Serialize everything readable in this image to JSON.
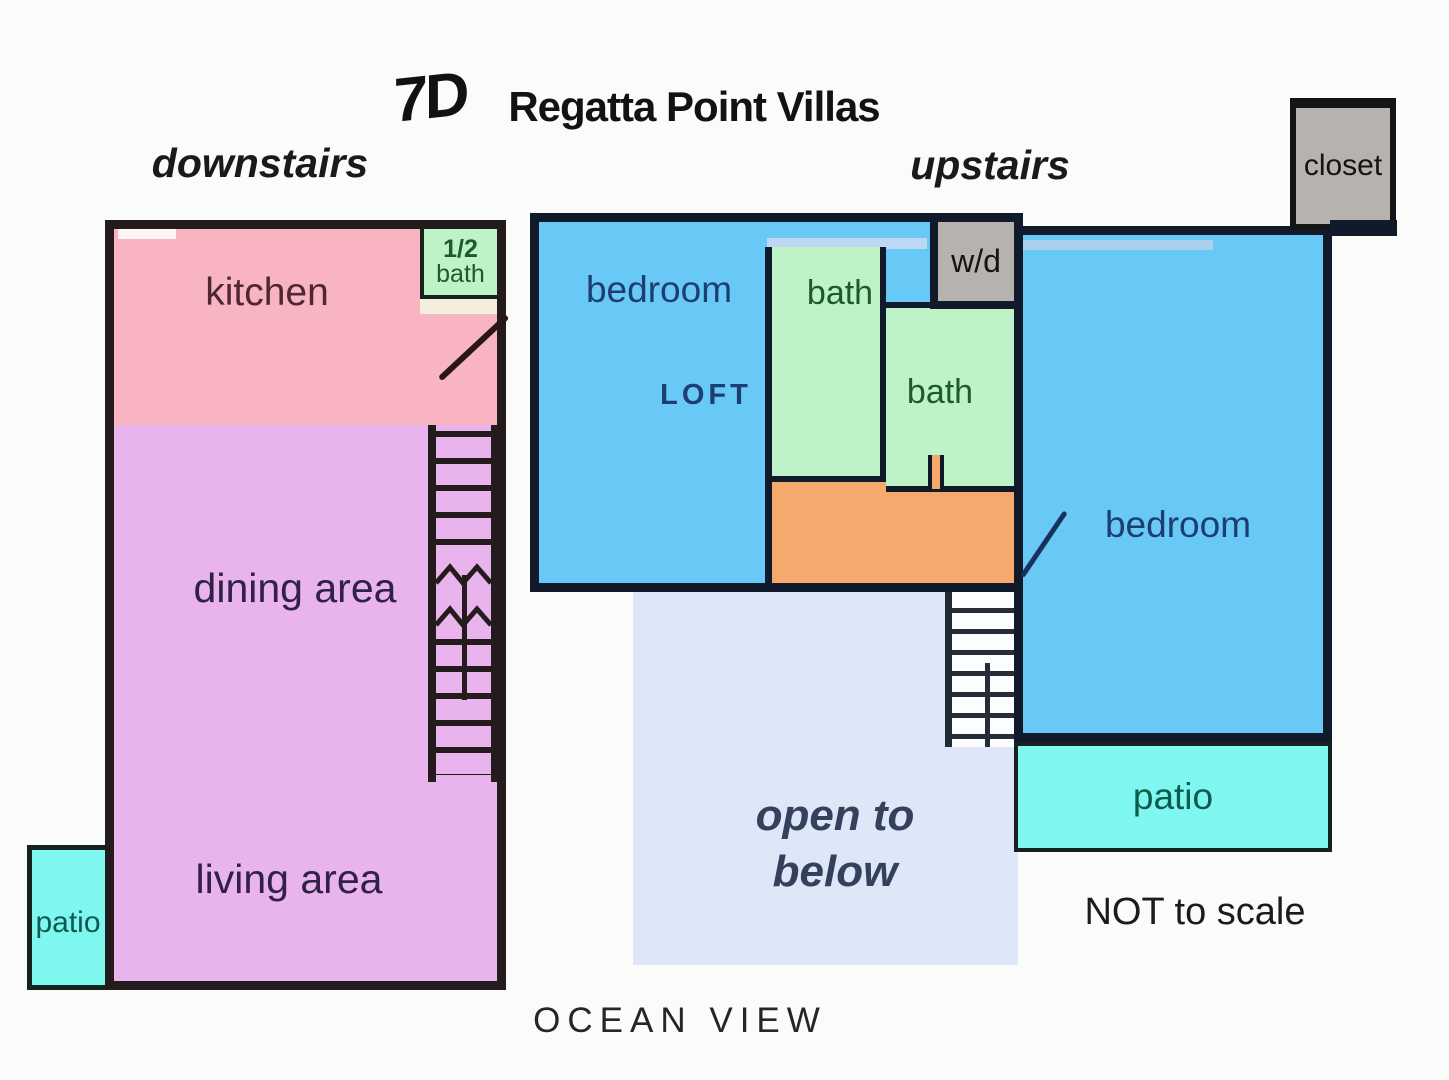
{
  "title": {
    "unit": "7D",
    "name": "Regatta Point Villas"
  },
  "floors": {
    "down": "downstairs",
    "up": "upstairs"
  },
  "down": {
    "kitchen": "kitchen",
    "half_bath_top": "1/2",
    "half_bath_bottom": "bath",
    "dining": "dining area",
    "living": "living area",
    "patio": "patio"
  },
  "up": {
    "bedroom_left": "bedroom",
    "loft": "LOFT",
    "bath_upper": "bath",
    "bath_lower": "bath",
    "wd": "w/d",
    "closet": "closet",
    "bedroom_right": "bedroom",
    "open_line1": "open to",
    "open_line2": "below",
    "patio": "patio"
  },
  "notes": {
    "scale": "NOT to scale",
    "view": "OCEAN VIEW"
  },
  "colors": {
    "kitchen": "#f8b4c1",
    "lilac": "#e9b4ee",
    "green": "#bdf3c6",
    "cyan": "#7ef7f0",
    "blue": "#68c8f6",
    "orange": "#f6a96d",
    "gray": "#b6b2ae",
    "openblue": "#dde7f7",
    "cream": "#f3eedd",
    "periwinkle": "#bcd8f4",
    "stair_bg": "#fbfdff",
    "wall_down": "#241c1c",
    "wall_up": "#101a2a",
    "text_kitchen": "#4e2733",
    "text_purple": "#302145",
    "text_green": "#1d5a2c",
    "text_teal": "#0e5a4e",
    "text_navy": "#1c3e70",
    "text_openblue": "#33415c"
  }
}
